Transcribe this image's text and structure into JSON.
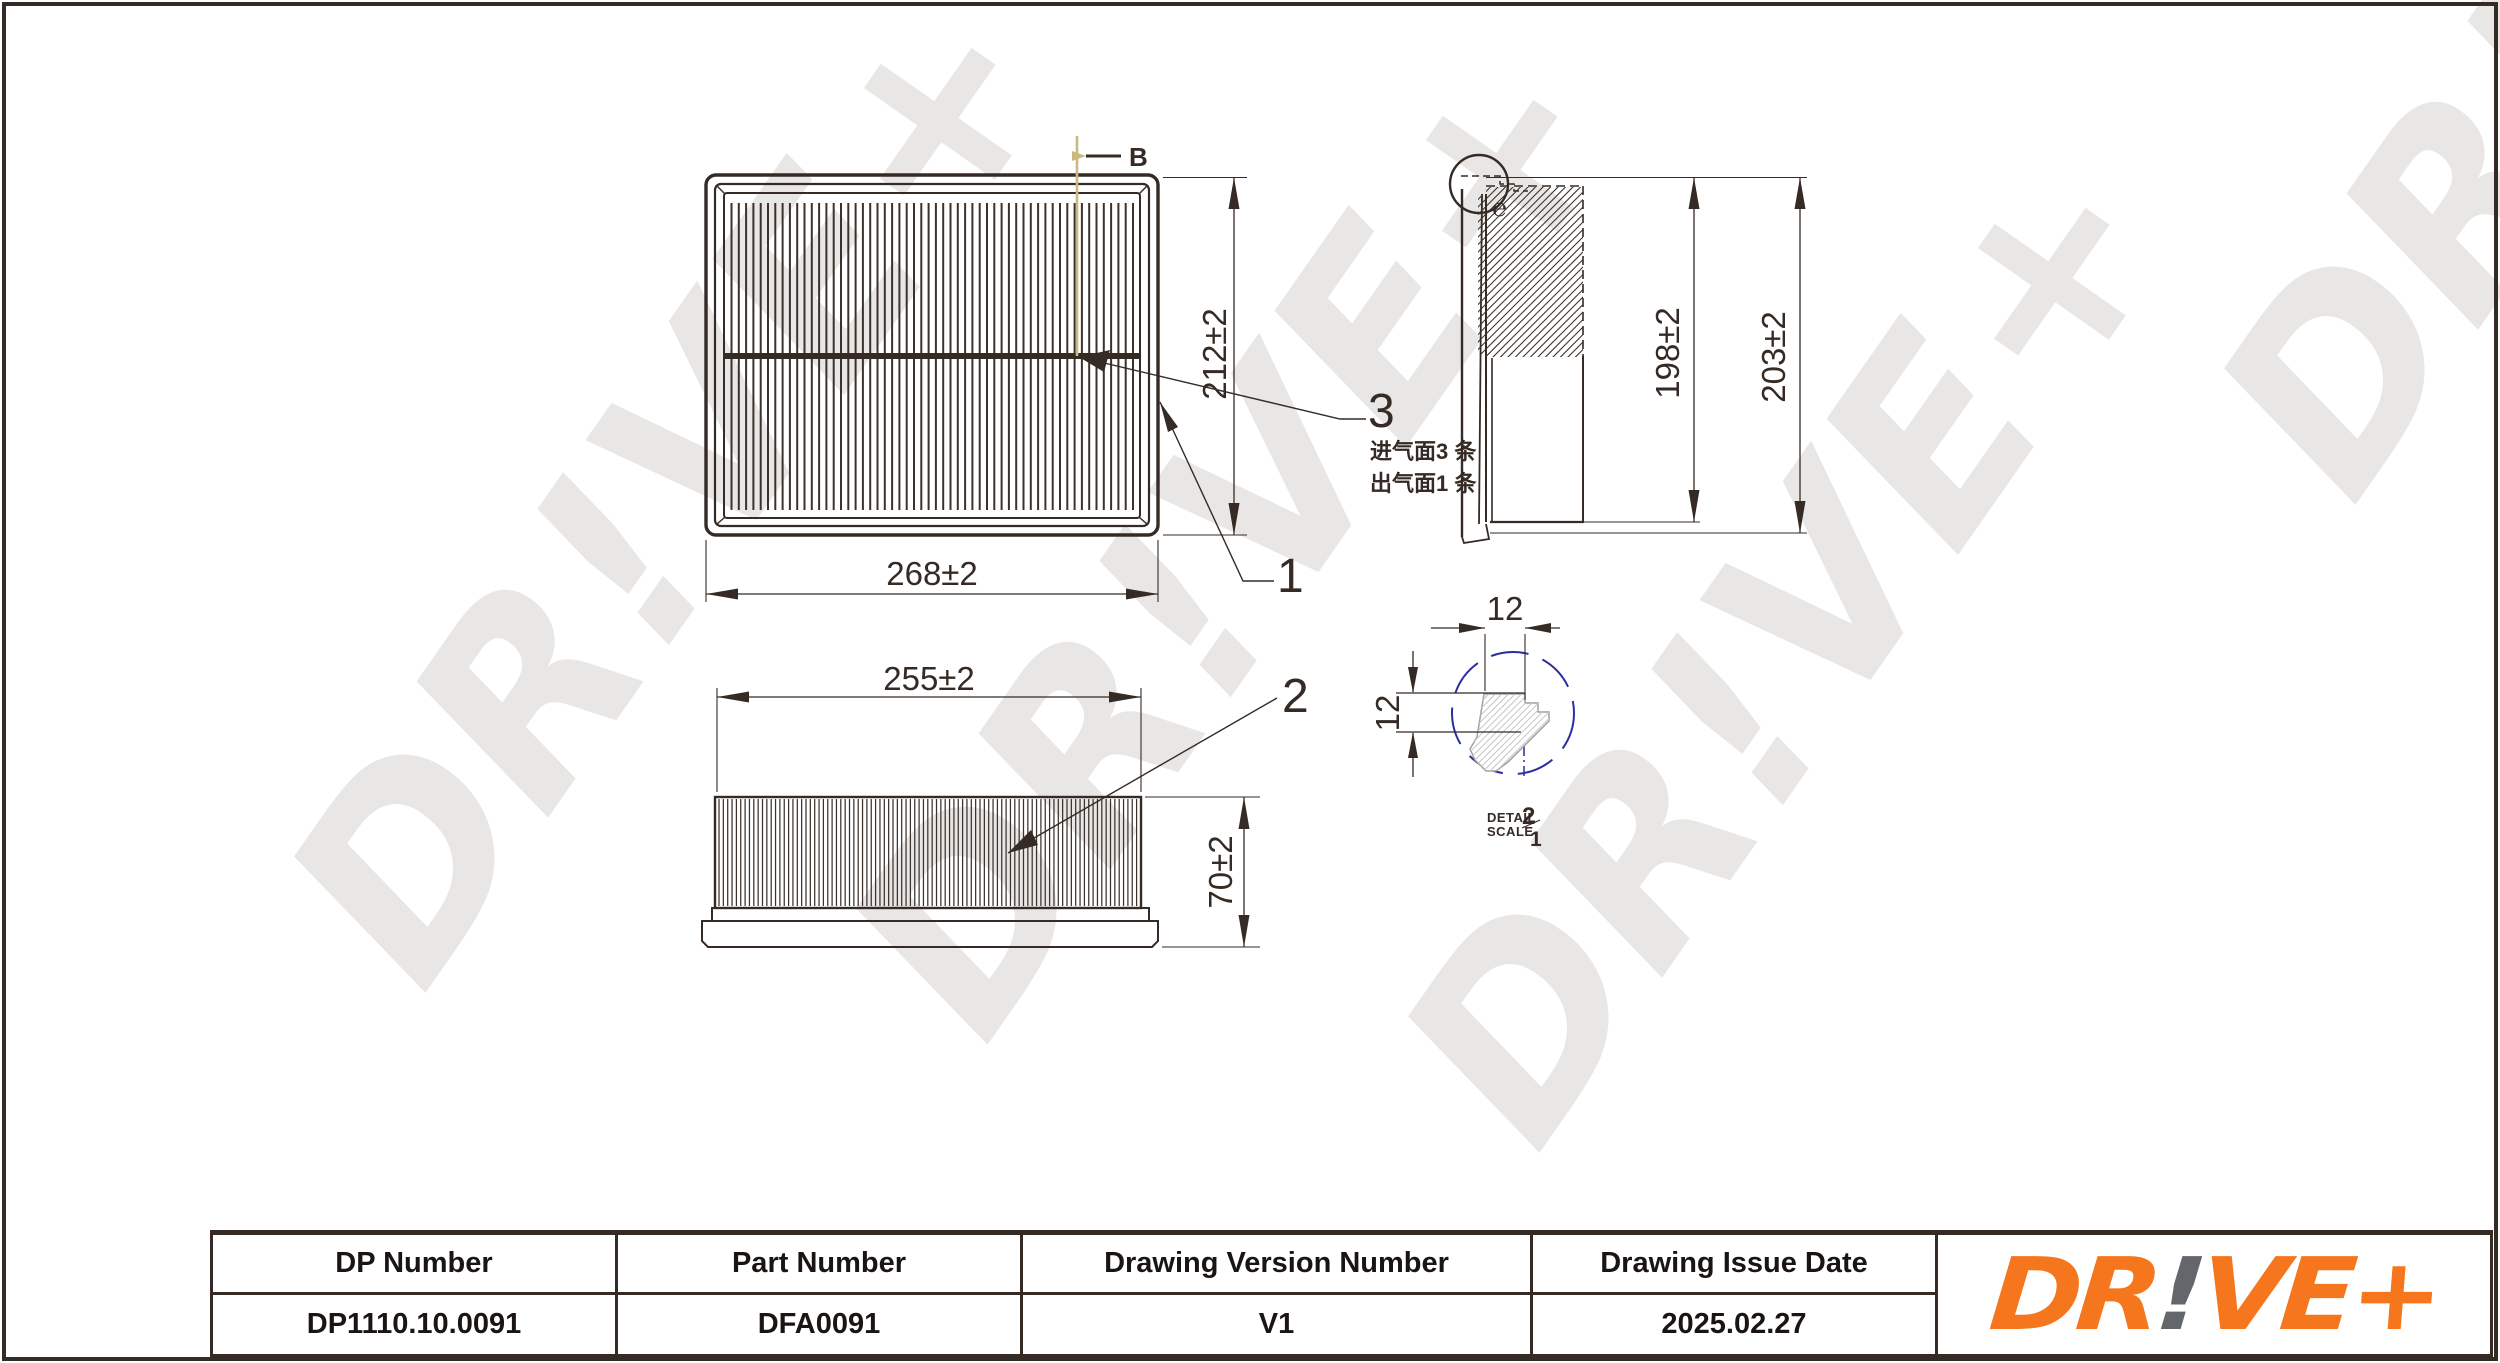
{
  "sheet": {
    "line_color": "#352a24",
    "background": "#ffffff"
  },
  "watermark": {
    "text": "DR!VE+",
    "color": "#e9e7e5"
  },
  "plan_view": {
    "section_label": "B",
    "width_dim": "268±2",
    "height_dim": "212±2"
  },
  "side_view": {
    "height_dim_inner": "198±2",
    "height_dim_outer": "203±2",
    "detail_mark": "℮",
    "note_line1": "进气面3 条",
    "note_line2": "出气面1 条"
  },
  "front_view": {
    "width_dim": "255±2",
    "height_dim": "70±2"
  },
  "detail_view": {
    "dim_width": "12",
    "dim_height": "12",
    "caption_line1": "DETAIL",
    "caption_line2": "SCALE",
    "scale_top": "2",
    "scale_bottom": "1",
    "circle_color": "#2b2f9e"
  },
  "callouts": {
    "frame": "1",
    "media": "2",
    "glue": "3"
  },
  "title_block": {
    "columns": [
      {
        "label": "DP Number",
        "value": "DP1110.10.0091"
      },
      {
        "label": "Part Number",
        "value": "DFA0091"
      },
      {
        "label": "Drawing Version Number",
        "value": "V1"
      },
      {
        "label": "Drawing Issue Date",
        "value": "2025.02.27"
      }
    ]
  },
  "logo": {
    "part1": "DR",
    "bang": "!",
    "part2": "VE+",
    "orange": "#f5761d",
    "gray": "#63666a"
  }
}
